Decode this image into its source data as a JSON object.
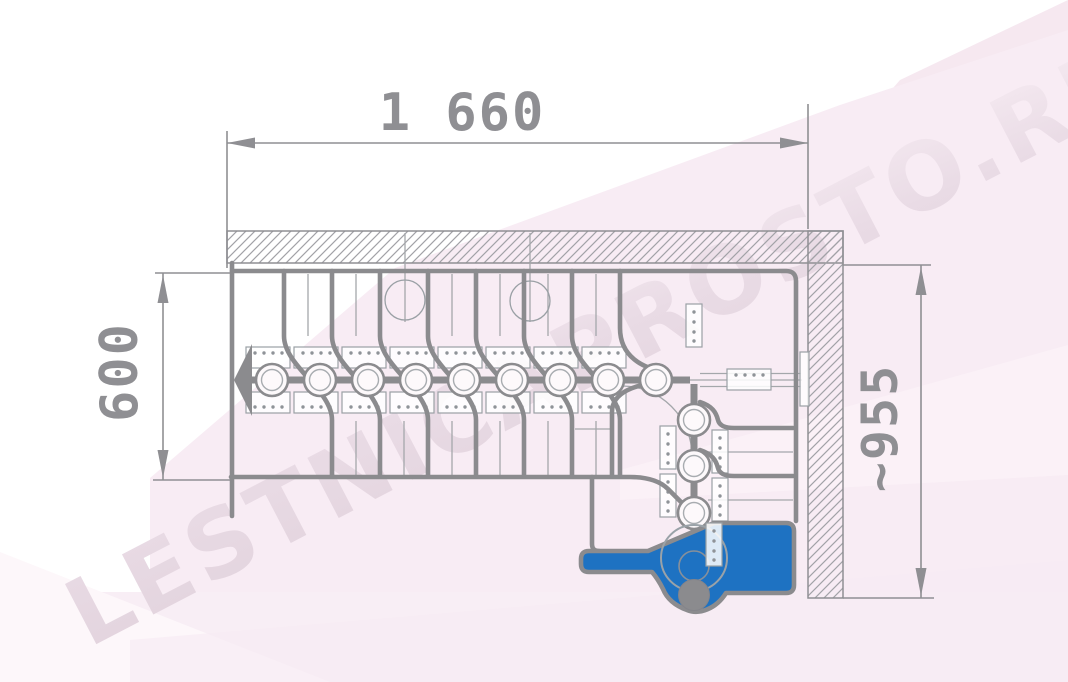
{
  "drawing": {
    "type": "staircase-plan-top-view",
    "dimensions": {
      "total_length_label": "1 660",
      "flight_width_label": "600",
      "turn_depth_label": "~955"
    },
    "watermark": "LESTNICAPROSTO.RU",
    "colors": {
      "line_gray": "#8b8b8e",
      "thin_gray": "#a0a0a5",
      "dim_gray": "#8f8f93",
      "first_step_blue": "#1e72c2",
      "background_pink": "#f8ecf4",
      "watermark_pink": "#ead9e4"
    },
    "elements": {
      "walls": "hatched-top-and-right",
      "modules": "central-spine-modular-stair",
      "first_step": "blue-highlighted-entry-step",
      "direction_arrow": "left-pointing-start-arrow"
    }
  }
}
